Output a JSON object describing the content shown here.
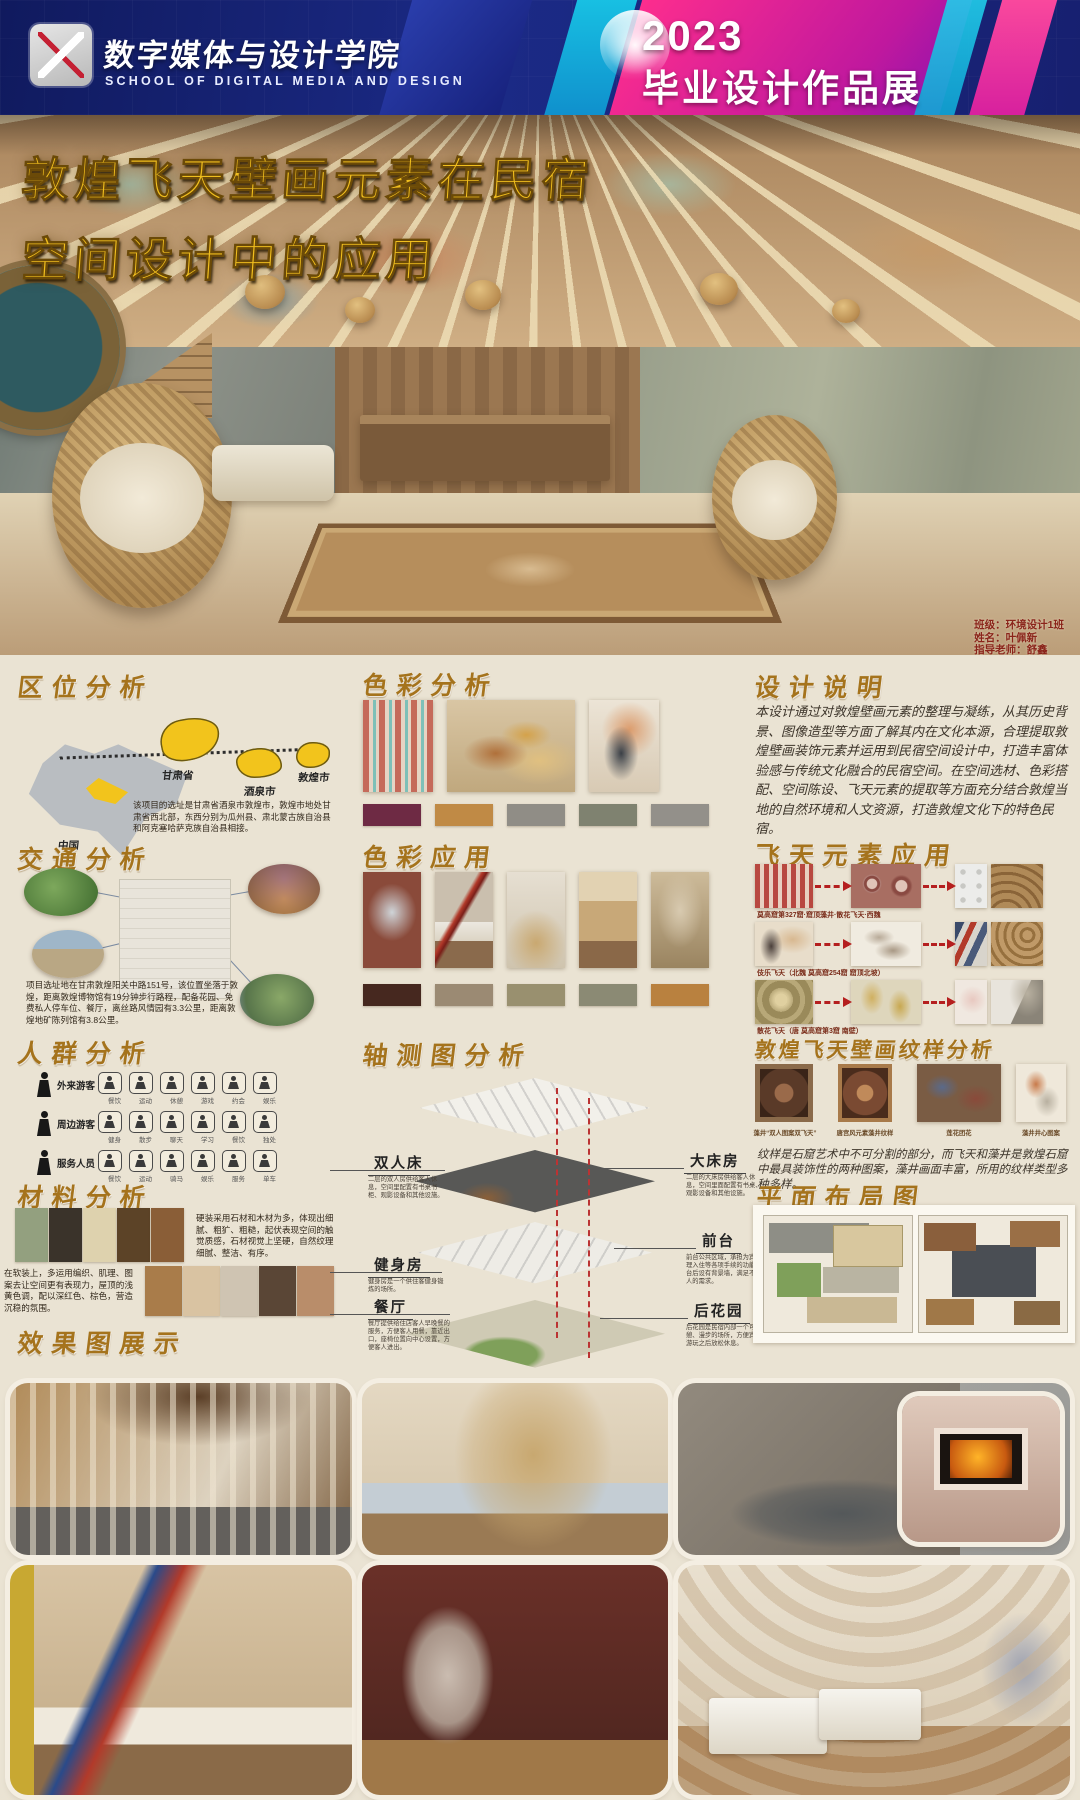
{
  "header": {
    "school_cn": "数字媒体与设计学院",
    "school_en": "SCHOOL OF DIGITAL MEDIA AND DESIGN",
    "year": "2023",
    "event": "毕业设计作品展"
  },
  "hero": {
    "title_line1": "敦煌飞天壁画元素在民宿",
    "title_line2": "空间设计中的应用",
    "credit_class": "班级：环境设计1班",
    "credit_name": "姓名：叶佩新",
    "credit_tutor": "指导老师：舒鑫"
  },
  "location": {
    "title": "区位分析",
    "labels": [
      "中国",
      "甘肃省",
      "酒泉市",
      "敦煌市"
    ],
    "text": "该项目的选址是甘肃省酒泉市敦煌市，敦煌市地处甘肃省西北部，东西分别为瓜州县、肃北蒙古族自治县和阿克塞哈萨克族自治县相接。"
  },
  "traffic": {
    "title": "交通分析",
    "text": "项目选址地在甘肃敦煌阳关中路151号，该位置坐落于敦煌，距离敦煌博物馆有19分钟步行路程，配备花园、免费私人停车位、餐厅，离丝路风情园有3.3公里，距离敦煌地矿陈列馆有3.8公里。"
  },
  "crowd": {
    "title": "人群分析",
    "groups": [
      {
        "label": "外来游客",
        "items": [
          "餐饮",
          "运动",
          "休憩",
          "游戏",
          "约会",
          "娱乐"
        ]
      },
      {
        "label": "周边游客",
        "items": [
          "健身",
          "散步",
          "聊天",
          "学习",
          "餐饮",
          "独处"
        ]
      },
      {
        "label": "服务人员",
        "items": [
          "餐饮",
          "运动",
          "骑马",
          "娱乐",
          "服务",
          "单车"
        ]
      }
    ]
  },
  "material": {
    "title": "材料分析",
    "text_hard": "硬装采用石材和木材为多，体现出细腻、粗犷、粗糙，起伏表现空间的触觉质感，石材视觉上坚硬，自然纹理细腻、整洁、有序。",
    "text_soft": "在软装上，多运用编织、肌理、图案去让空间更有表现力，屋顶的浅黄色调，配以深红色、棕色，营造沉稳的氛围。",
    "hard_swatches": [
      "#93a07f",
      "#3a332a",
      "#ded2ae",
      "#5c4327",
      "#8a5e37"
    ],
    "soft_swatches": [
      "#a97c4a",
      "#d9c3a2",
      "#cfc4b2",
      "#5a4636",
      "#b98d6a"
    ]
  },
  "color_analysis": {
    "title": "色彩分析",
    "swatches": [
      "#6e2a44",
      "#c08a45",
      "#908d86",
      "#7f8270",
      "#93908a"
    ]
  },
  "color_application": {
    "title": "色彩应用",
    "swatches": [
      "#46281f",
      "#9b8a73",
      "#99906f",
      "#8b8a74",
      "#b9813f"
    ]
  },
  "axon": {
    "title": "轴测图分析",
    "left": [
      {
        "name": "双人床",
        "desc": "二层的双人房供给客人休息，空间里配置有书桌书柜、观影设备和其他设施。"
      },
      {
        "name": "健身房",
        "desc": "健身房是一个供住客健身锻炼的场所。"
      },
      {
        "name": "餐厅",
        "desc": "餐厅提供给住店客人早晚餐的服务，方便客人用餐，靠近出口，座椅位置向中心设置，方便客人进出。"
      }
    ],
    "right": [
      {
        "name": "大床房",
        "desc": "二层的大床房供给客人休息，空间里面配置有书桌、观影设备和其他设施。"
      },
      {
        "name": "前台",
        "desc": "前台公共区域，承担为宾客办理入住等各项手续的功能，前台后设有背景墙，满足不同客人的需求。"
      },
      {
        "name": "后花园",
        "desc": "后花园是民宿内部一个可供休憩、漫步的场所，方便宾客在游玩之后放松休息。"
      }
    ]
  },
  "design_note": {
    "title": "设计说明",
    "text": "本设计通过对敦煌壁画元素的整理与凝练，从其历史背景、图像造型等方面了解其内在文化本源，合理提取敦煌壁画装饰元素并运用到民宿空间设计中，打造丰富体验感与传统文化融合的民宿空间。在空间选材、色彩搭配、空间陈设、飞天元素的提取等方面充分结合敦煌当地的自然环境和人文资源，打造敦煌文化下的特色民宿。"
  },
  "fly": {
    "title": "飞天元素应用",
    "rows": [
      {
        "caption": "莫高窟第327窟·窟顶藻井·散花飞天·西魏"
      },
      {
        "caption": "伎乐飞天（北魏 莫高窟254窟 窟顶北坡）"
      },
      {
        "caption": "散花飞天（唐 莫高窟第3窟 南壁）"
      }
    ]
  },
  "pattern": {
    "title": "敦煌飞天壁画纹样分析",
    "captions": [
      "藻井“双人图案双飞天”",
      "唐宫风元素藻井纹样",
      "莲花团花",
      "藻井井心图案"
    ],
    "text": "纹样是石窟艺术中不可分割的部分，而飞天和藻井是敦煌石窟中最具装饰性的两种图案，藻井画面丰富，所用的纹样类型多种多样。"
  },
  "floor_plan": {
    "title": "平面布局图"
  },
  "renders": {
    "title": "效果图展示"
  },
  "palette": {
    "poster_bg": "#eae3d3",
    "title_gold": "#f0be1e",
    "section_title": "#a5731c",
    "accent_red": "#b51f1f"
  }
}
